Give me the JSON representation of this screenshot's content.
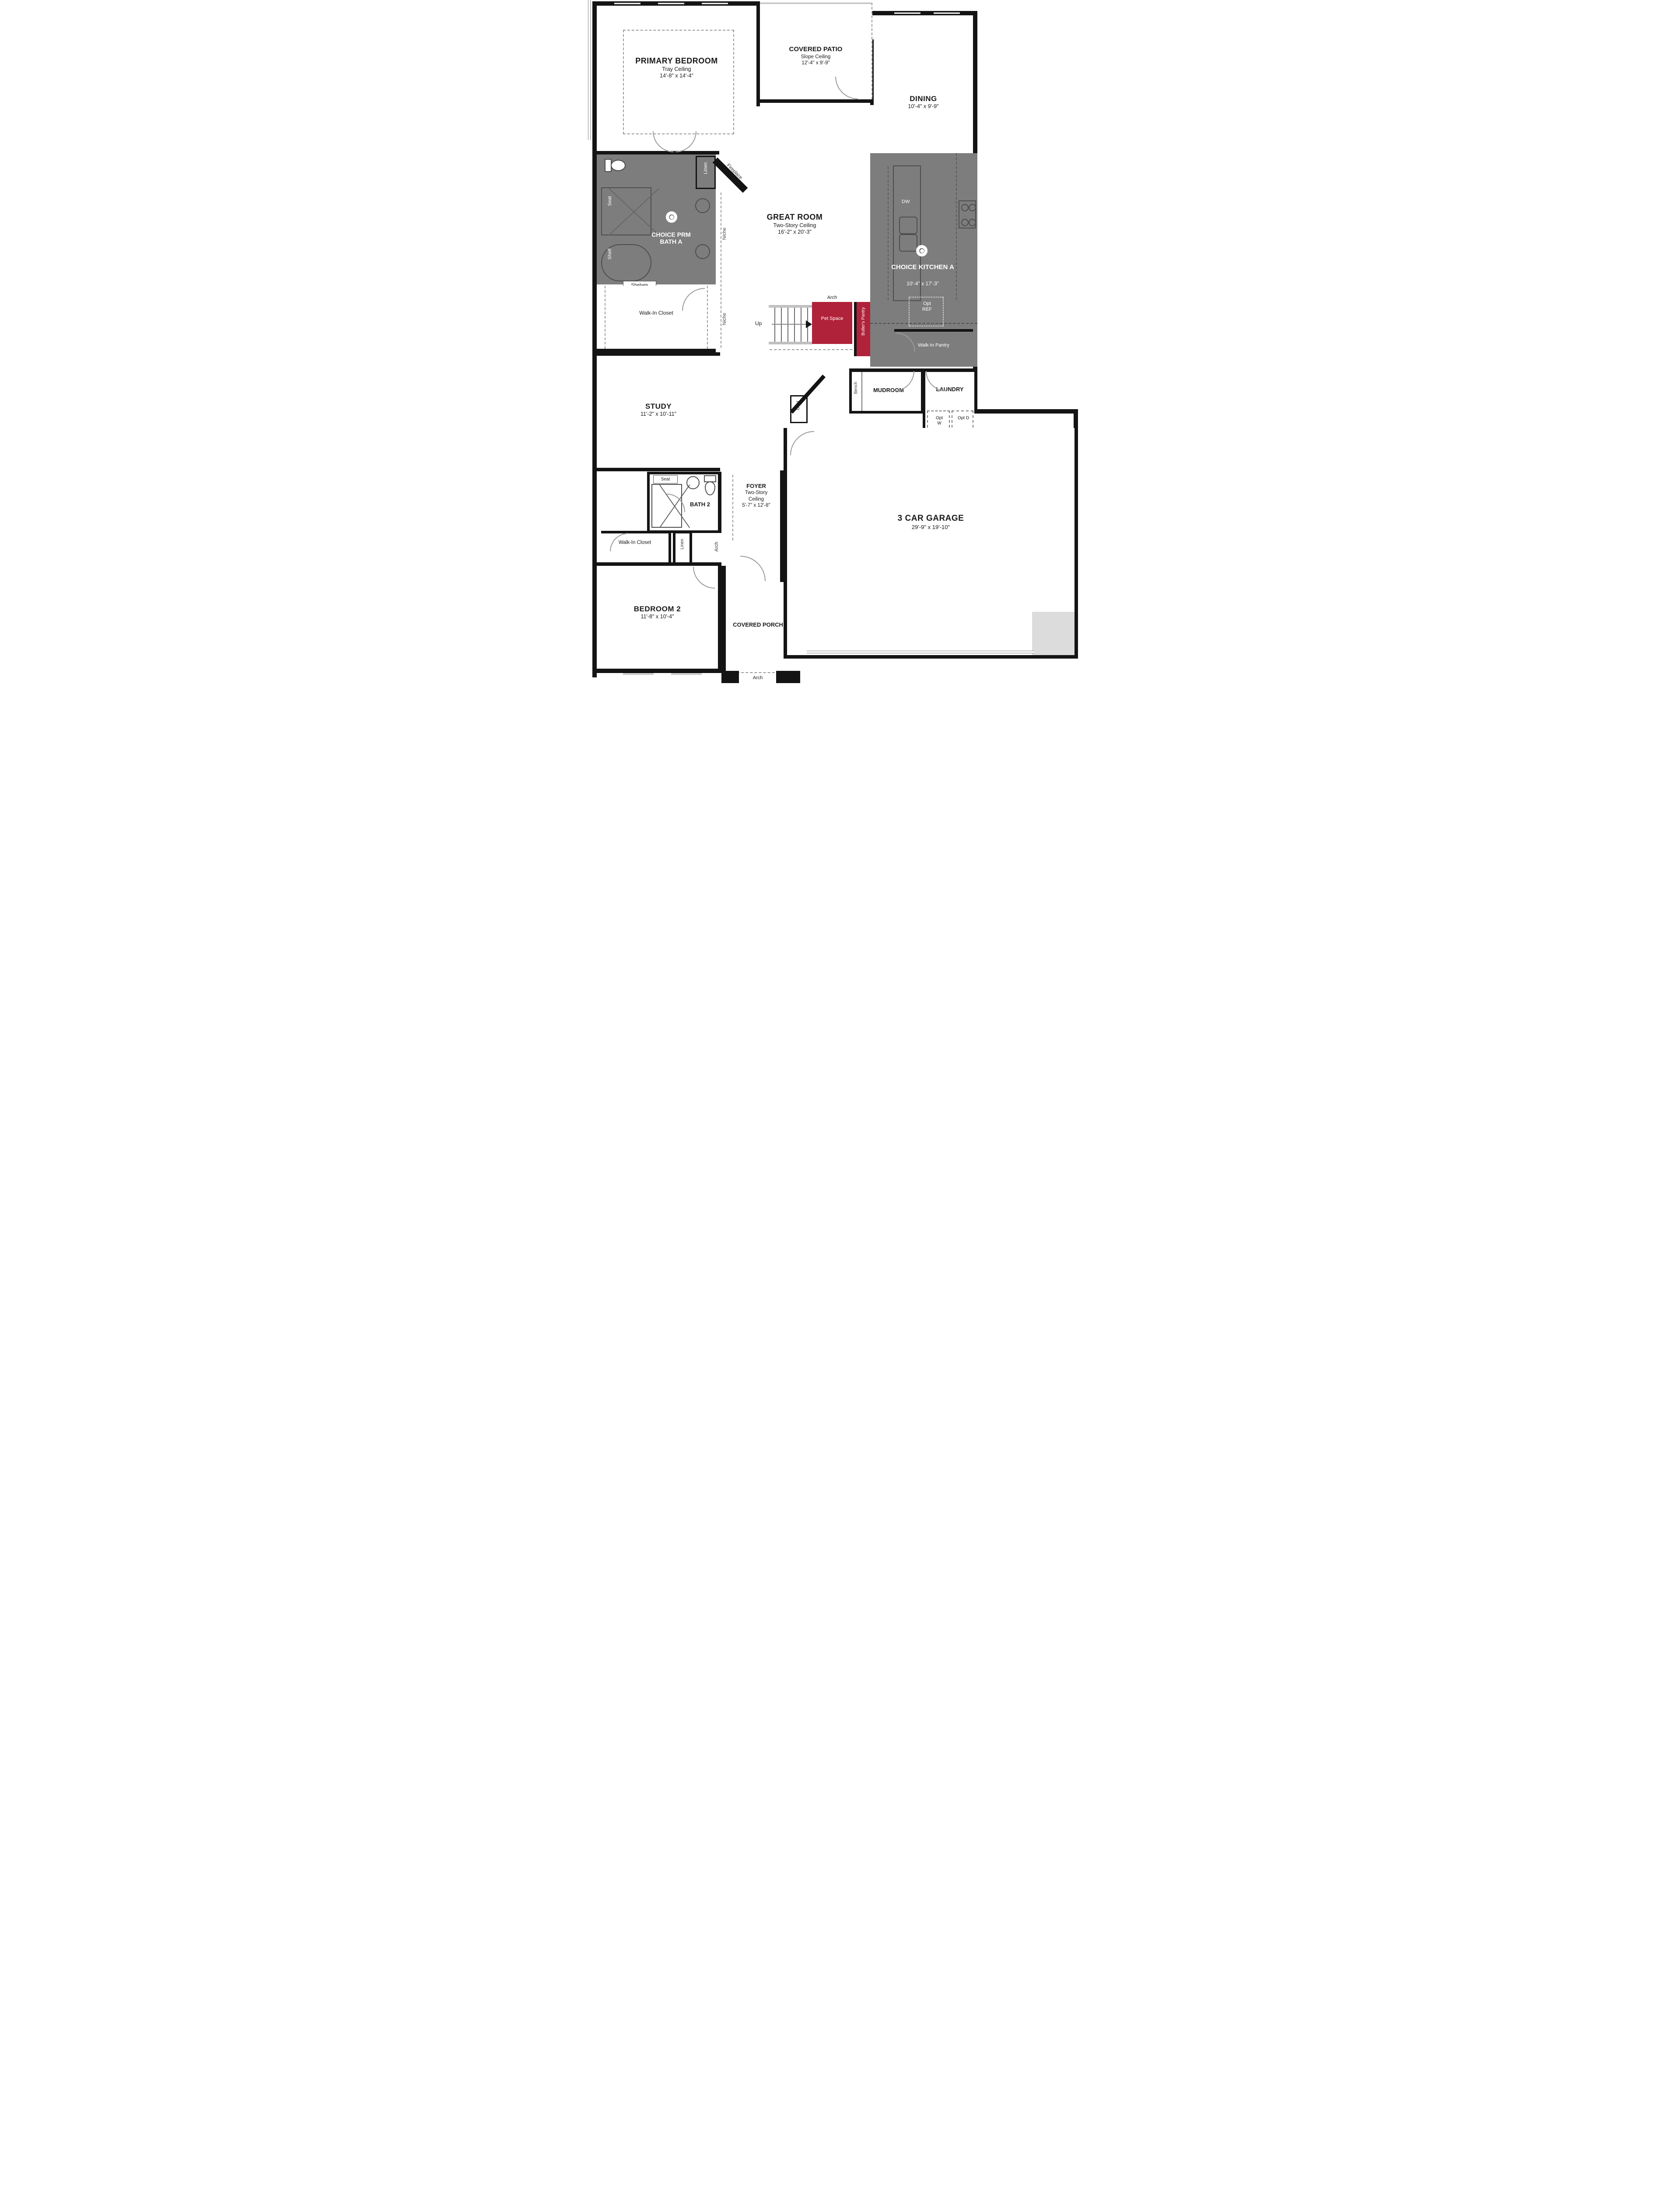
{
  "plan": {
    "type": "floor-plan",
    "colors": {
      "wall": "#141414",
      "option_gray": "#7d7d7d",
      "option_red": "#b02239",
      "paper": "#ffffff"
    },
    "rooms": {
      "primary_bedroom": {
        "name": "PRIMARY BEDROOM",
        "ceiling": "Tray Ceiling",
        "dims": "14'-8\" x 14'-4\""
      },
      "covered_patio": {
        "name": "COVERED PATIO",
        "ceiling": "Slope Ceiling",
        "dims": "12'-4\" x 9'-9\""
      },
      "dining": {
        "name": "DINING",
        "dims": "10'-4\" x 9'-9\""
      },
      "great_room": {
        "name": "GREAT ROOM",
        "ceiling": "Two-Story Ceiling",
        "dims": "16'-2\" x 20'-3\""
      },
      "prm_bath": {
        "name": "CHOICE PRM BATH A"
      },
      "kitchen": {
        "name": "CHOICE KITCHEN A",
        "dims": "10'-4\" x 17'-3\""
      },
      "walk_in_pantry": {
        "name": "Walk-In Pantry"
      },
      "pet_space": {
        "name": "Pet Space"
      },
      "butlers_pantry": {
        "name": "Butler's Pantry"
      },
      "mudroom": {
        "name": "MUDROOM"
      },
      "laundry": {
        "name": "LAUNDRY"
      },
      "study": {
        "name": "STUDY",
        "dims": "11'-2\" x 10'-11\""
      },
      "bath2": {
        "name": "BATH 2"
      },
      "foyer": {
        "name": "FOYER",
        "ceiling": "Two-Story Ceiling",
        "dims": "5'-7\" x 12'-8\""
      },
      "wic_primary": {
        "name": "Walk-In Closet"
      },
      "wic2": {
        "name": "Walk-In Closet"
      },
      "bedroom2": {
        "name": "BEDROOM 2",
        "dims": "11'-8\" x 10'-4\""
      },
      "covered_porch": {
        "name": "COVERED PORCH"
      },
      "garage": {
        "name": "3 CAR GARAGE",
        "dims": "29'-9\" x 19'-10\""
      }
    },
    "labels": {
      "seat": "Seat",
      "shelf": "Shelf",
      "shelves": "Shelves",
      "linen": "Linen",
      "niche": "Niche",
      "fireplace": "Fireplace",
      "up": "Up",
      "arch": "Arch",
      "bench": "Bench",
      "coat": "Coat",
      "dw": "DW",
      "opt_ref": "Opt REF",
      "opt_w": "Opt W",
      "opt_d": "Opt D",
      "wh": "WH"
    }
  }
}
